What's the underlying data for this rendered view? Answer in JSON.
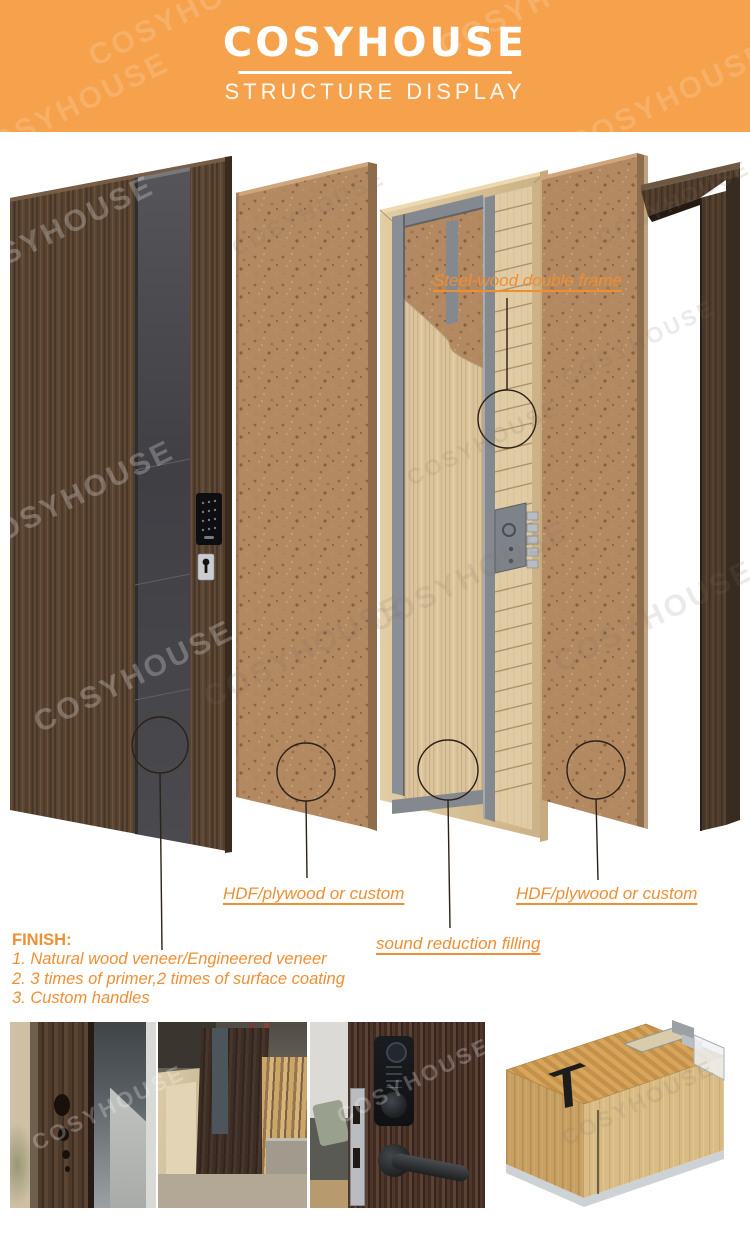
{
  "header": {
    "title": "COSYHOUSE",
    "subtitle": "STRUCTURE DISPLAY"
  },
  "watermark": {
    "text": "COSYHOUSE"
  },
  "diagram": {
    "labels": {
      "steel_frame": "Steel-wood double frame",
      "hdf_left": "HDF/plywood or custom",
      "sound": "sound reduction filling",
      "hdf_right": "HDF/plywood or custom"
    }
  },
  "finish": {
    "heading": "FINISH:",
    "items": [
      "1. Natural wood veneer/Engineered veneer",
      "2. 3 times of primer,2 times of surface coating",
      "3. Custom handles"
    ]
  },
  "colors": {
    "header_bg": "#F6A14B",
    "accent_text": "#EE8F33",
    "annotation_line": "#2B2118"
  }
}
